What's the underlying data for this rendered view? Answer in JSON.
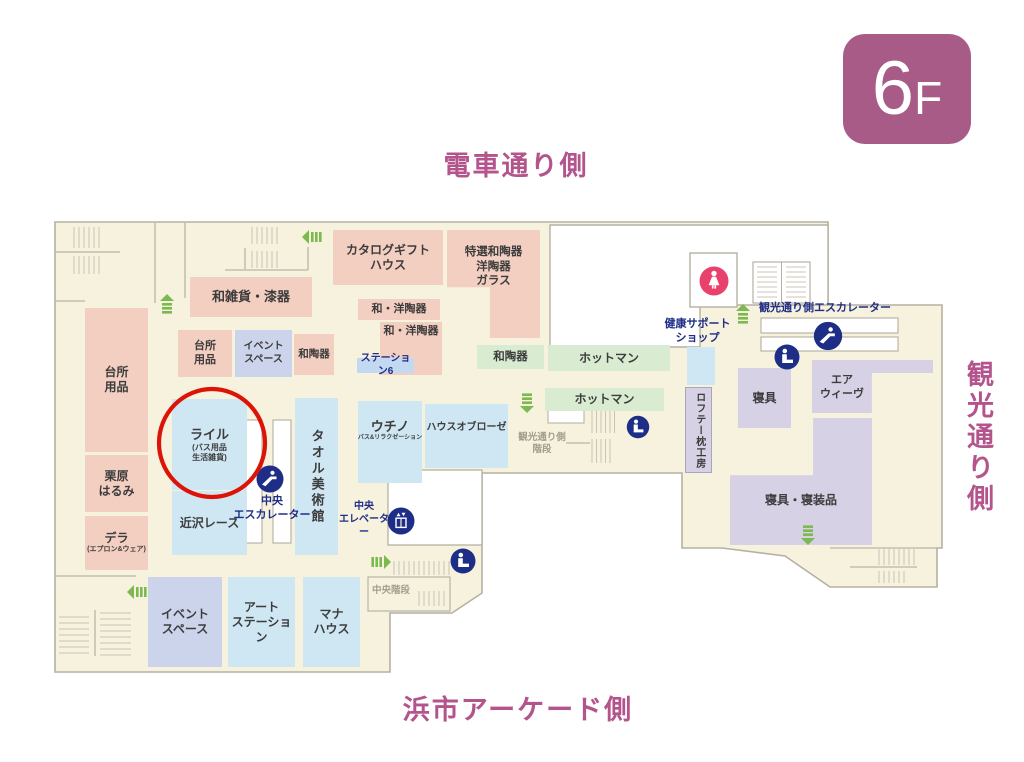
{
  "floor_badge": {
    "number": "6",
    "suffix": "F"
  },
  "direction_labels": {
    "top": "電車通り側",
    "right": "観光通り側",
    "bottom": "浜市アーケード側"
  },
  "shops": {
    "wazakka_shikki": {
      "label": "和雑貨・漆器"
    },
    "catalog_gift_house": {
      "label": "カタログギフト\nハウス"
    },
    "tokusen_watouki": {
      "label": "特選和陶器\n洋陶器\nガラス"
    },
    "wayou_touki_1": {
      "label": "和・洋陶器"
    },
    "wayou_touki_2": {
      "label": "和・洋陶器"
    },
    "station6": {
      "label": "ステーション6"
    },
    "daidokoro_small": {
      "label": "台所\n用品"
    },
    "event_space_top": {
      "label": "イベント\nスペース"
    },
    "watouki_pink": {
      "label": "和陶器"
    },
    "daidokoro_tall": {
      "label": "台所\n用品"
    },
    "kurihara_harumi": {
      "label": "栗原\nはるみ"
    },
    "dera": {
      "label": "デラ",
      "sub": "(エプロン&ウェア)"
    },
    "lyle": {
      "label": "ライル",
      "sub": "(バス用品\n生活雑貨)"
    },
    "chikazawa_lace": {
      "label": "近沢レース"
    },
    "towel_museum": {
      "label": "タオル美術館"
    },
    "uchino": {
      "label": "ウチノ",
      "sub": "バス&リラクゼーション"
    },
    "house_of_rose": {
      "label": "ハウスオブローゼ"
    },
    "event_space_bottom": {
      "label": "イベント\nスペース"
    },
    "art_station": {
      "label": "アート\nステーション"
    },
    "mana_house": {
      "label": "マナ\nハウス"
    },
    "watouki_green": {
      "label": "和陶器"
    },
    "hotman_1": {
      "label": "ホットマン"
    },
    "hotman_2": {
      "label": "ホットマン"
    },
    "shingu": {
      "label": "寝具"
    },
    "airweave": {
      "label": "エア\nウィーヴ"
    },
    "shingu_shinsouhin": {
      "label": "寝具・寝装品"
    },
    "loftee_makura_koubou": {
      "label": "ロフテー枕工房"
    }
  },
  "facilities": {
    "health_support_shop": "健康サポート\nショップ",
    "kankou_side_escalator": "観光通り側エスカレーター",
    "central_escalator": "中央\nエスカレーター",
    "central_elevator": "中央\nエレベーター",
    "kankou_side_stairs": "観光通り側\n階段",
    "central_stairs": "中央階段"
  },
  "icons": {
    "escalator_icon": "navy circle, person on escalator steps",
    "elevator_icon": "navy circle, elevator cab with up/down arrows",
    "service_icon": "navy circle, person with luggage",
    "women_restroom_icon": "crimson circle, female figure",
    "green_arrow": "escalator direction arrow",
    "stairs_hatch": "parallel tick lines",
    "highlight_circle": "red ellipse around Lyle shop"
  },
  "colors": {
    "map_floor": "#f6f2de",
    "map_border": "#b5b1a2",
    "shop_pink": "#f3cfc2",
    "shop_blue": "#cfe6f3",
    "shop_periwinkle": "#ccd4ec",
    "shop_green": "#d9ecd2",
    "shop_purple": "#d7d1e5",
    "navy": "#1e2e87",
    "mauve": "#b4548c",
    "badge_bg": "#a85b87",
    "highlight_red": "#dc1408",
    "restroom_pink": "#e8416b",
    "arrow_green": "#7cb94e"
  }
}
